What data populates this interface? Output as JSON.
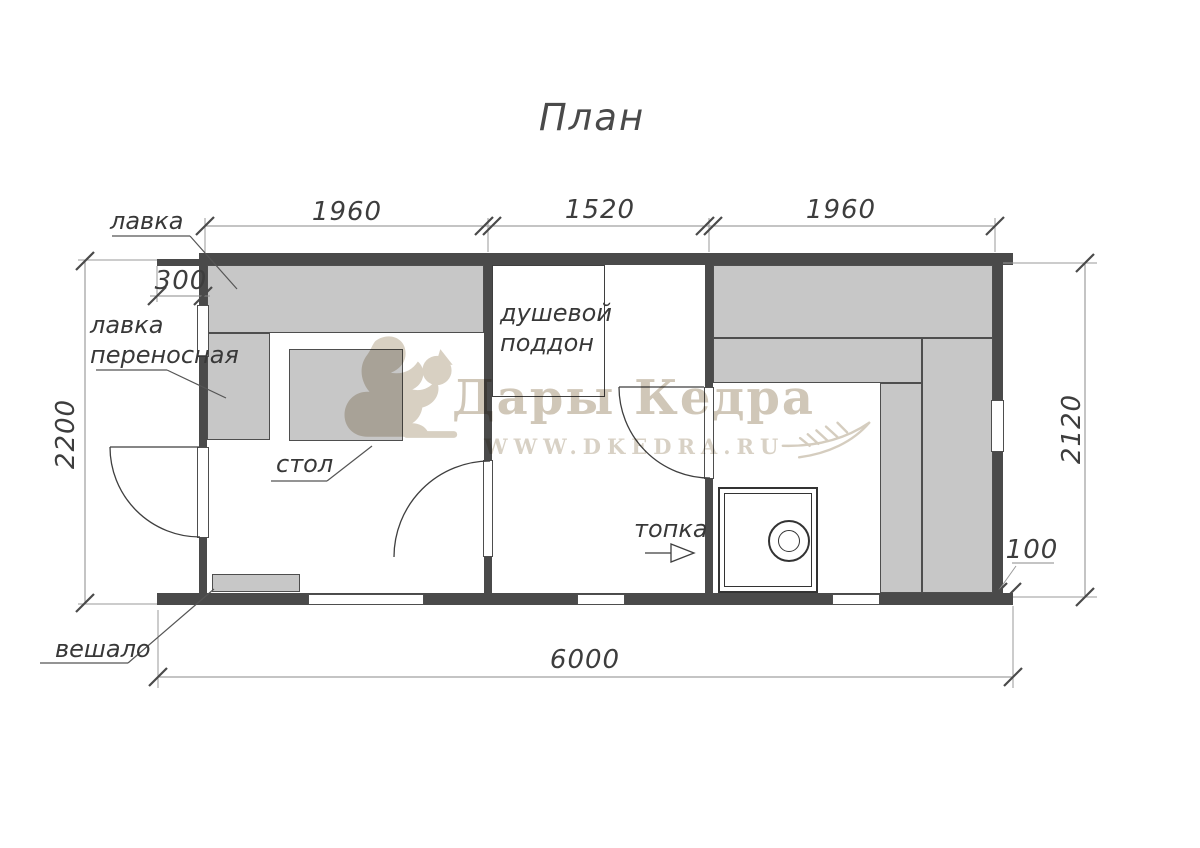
{
  "title": "План",
  "watermark": {
    "brand": "Дары Кедра",
    "url": "WWW.DKEDRA.RU"
  },
  "dimensions": {
    "top_left": "1960",
    "top_mid": "1520",
    "top_right": "1960",
    "porch_offset": "300",
    "left_height": "2200",
    "right_height": "2120",
    "right_offset": "100",
    "total_width": "6000"
  },
  "labels": {
    "bench": "лавка",
    "portable_bench": [
      "лавка",
      "переносная"
    ],
    "table": "стол",
    "shower_tray": [
      "душевой",
      "поддон"
    ],
    "firebox": "топка",
    "hanger": "вешало"
  }
}
